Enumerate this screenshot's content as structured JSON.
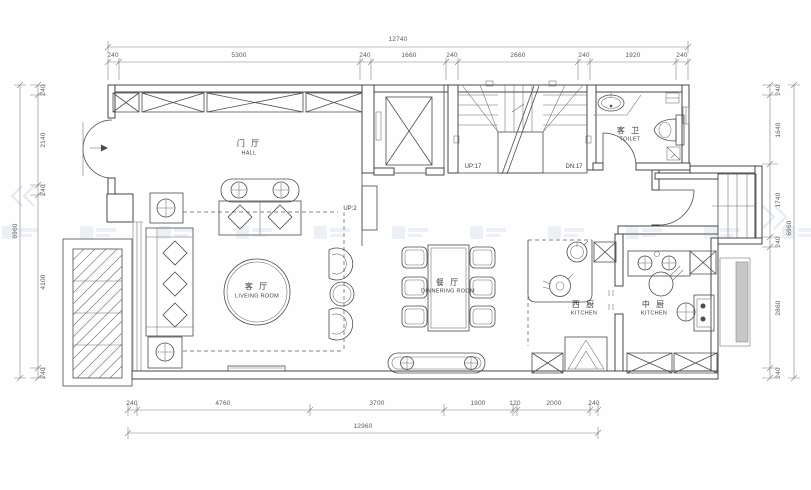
{
  "drawing": {
    "rooms": {
      "hall": {
        "name_cn": "门 厅",
        "name_en": "HALL"
      },
      "living_room": {
        "name_cn": "客 厅",
        "name_en": "LIVEING ROOM"
      },
      "dining_room": {
        "name_cn": "餐 厅",
        "name_en": "DINNERING ROOM"
      },
      "west_kitchen": {
        "name_cn": "西 厨",
        "name_en": "KITCHEN"
      },
      "chinese_kitchen": {
        "name_cn": "中 厨",
        "name_en": "KITCHEN"
      },
      "toilet": {
        "name_cn": "客 卫",
        "name_en": "TOILET"
      }
    },
    "stairs": {
      "hall_step_label": "UP:2",
      "up_label": "UP:17",
      "down_label": "DN:17"
    },
    "dimensions": {
      "top": {
        "overall": "12740",
        "segments": [
          "240",
          "5300",
          "240",
          "1660",
          "240",
          "2660",
          "240",
          "1920",
          "240"
        ]
      },
      "bottom": {
        "overall": "12960",
        "segments": [
          "240",
          "4760",
          "3700",
          "1900",
          "120",
          "2000",
          "240"
        ]
      },
      "left": {
        "overall": "6960",
        "segments": [
          "240",
          "2140",
          "240",
          "4100",
          "240"
        ]
      },
      "right": {
        "overall": "6960",
        "segments": [
          "240",
          "1640",
          "1740",
          "240",
          "2860",
          "240"
        ]
      }
    },
    "colors": {
      "line": "#4c4c4c",
      "dimension": "#828282",
      "gray_fill": "#c7c7c7",
      "watermark": "#7d9cbe",
      "background": "#ffffff"
    }
  }
}
